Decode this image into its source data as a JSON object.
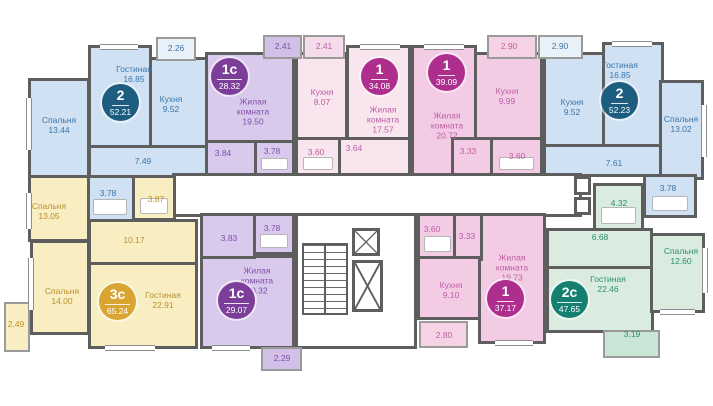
{
  "plan_title": "Floor plan with 9 apartments",
  "colors": {
    "wall": "#5e5e5e",
    "blue": {
      "fill": "#cfe1f2",
      "badge": "#1d5e80",
      "text": "#3b76ab"
    },
    "purple": {
      "fill": "#d9c9ec",
      "badge": "#7c3e99",
      "text": "#7e4fa8"
    },
    "pink_light": {
      "fill": "#f8e5ee",
      "badge": "#ae2e8e",
      "text": "#bc5ea6"
    },
    "pink": {
      "fill": "#f3cbe4",
      "badge": "#ae2e8e",
      "text": "#bc5ea6"
    },
    "yellow": {
      "fill": "#f9eec2",
      "badge": "#d9a432",
      "text": "#b8902e"
    },
    "teal": {
      "fill": "#d9ecdf",
      "badge": "#15806f",
      "text": "#2e8e74"
    }
  },
  "apartments": {
    "a1": {
      "type": "2",
      "total": "52.21",
      "rooms": {
        "living": {
          "name": "Гостиная",
          "area": "16.85"
        },
        "kitchen": {
          "name": "Кухня",
          "area": "9.52"
        },
        "bedroom": {
          "name": "Спальня",
          "area": "13.44"
        },
        "hall": {
          "area": "7.49"
        },
        "bath": {
          "area": "3.78"
        },
        "balcony": {
          "area": "2.26"
        }
      }
    },
    "a2": {
      "type": "1с",
      "total": "28.32",
      "rooms": {
        "main": {
          "name": "Жилая комната",
          "area": "19.50"
        },
        "hall": {
          "area": "3.84"
        },
        "bath": {
          "area": "3.78"
        },
        "balcony": {
          "area": "2.41"
        }
      }
    },
    "a3": {
      "type": "1",
      "total": "34.08",
      "rooms": {
        "kitchen": {
          "name": "Кухня",
          "area": "8.07"
        },
        "main": {
          "name": "Жилая комната",
          "area": "17.57"
        },
        "bath": {
          "area": "3.60"
        },
        "hall": {
          "area": "3.64"
        },
        "balcony": {
          "area": "2.41"
        }
      }
    },
    "a4": {
      "type": "1",
      "total": "39.09",
      "rooms": {
        "main": {
          "name": "Жилая комната",
          "area": "20.72"
        },
        "kitchen": {
          "name": "Кухня",
          "area": "9.99"
        },
        "hall": {
          "area": "3.33"
        },
        "bath": {
          "area": "3.60"
        },
        "balcony": {
          "area": "2.90"
        }
      }
    },
    "a5": {
      "type": "2",
      "total": "52.23",
      "rooms": {
        "living": {
          "name": "Гостиная",
          "area": "16.85"
        },
        "kitchen": {
          "name": "Кухня",
          "area": "9.52"
        },
        "bedroom": {
          "name": "Спальня",
          "area": "13.02"
        },
        "hall": {
          "area": "7.61"
        },
        "bath": {
          "area": "3.78"
        },
        "balcony": {
          "area": "2.90"
        }
      }
    },
    "a6": {
      "type": "3с",
      "total": "65.24",
      "rooms": {
        "bedroom1": {
          "name": "Спальня",
          "area": "13.05"
        },
        "bedroom2": {
          "name": "Спальня",
          "area": "14.00"
        },
        "living": {
          "name": "Гостиная",
          "area": "22.91"
        },
        "hall": {
          "area": "10.17"
        },
        "bath": {
          "area": "3.87"
        },
        "balcony": {
          "area": "2.49"
        }
      }
    },
    "a7": {
      "type": "1с",
      "total": "29.07",
      "rooms": {
        "main": {
          "name": "Жилая комната",
          "area": "20.32"
        },
        "hall": {
          "area": "3.83"
        },
        "bath": {
          "area": "3.78"
        },
        "balcony": {
          "area": "2.29"
        }
      }
    },
    "a8": {
      "type": "1",
      "total": "37.17",
      "rooms": {
        "main": {
          "name": "Жилая комната",
          "area": "19.73"
        },
        "kitchen": {
          "name": "Кухня",
          "area": "9.10"
        },
        "bath": {
          "area": "3.60"
        },
        "hall": {
          "area": "3.33"
        },
        "balcony": {
          "area": "2.80"
        }
      }
    },
    "a9": {
      "type": "2с",
      "total": "47.65",
      "rooms": {
        "living": {
          "name": "Гостиная",
          "area": "22.46"
        },
        "bedroom": {
          "name": "Спальня",
          "area": "12.60"
        },
        "hall": {
          "area": "6.68"
        },
        "bath": {
          "area": "4.32"
        },
        "balcony": {
          "area": "3.19"
        }
      }
    }
  }
}
